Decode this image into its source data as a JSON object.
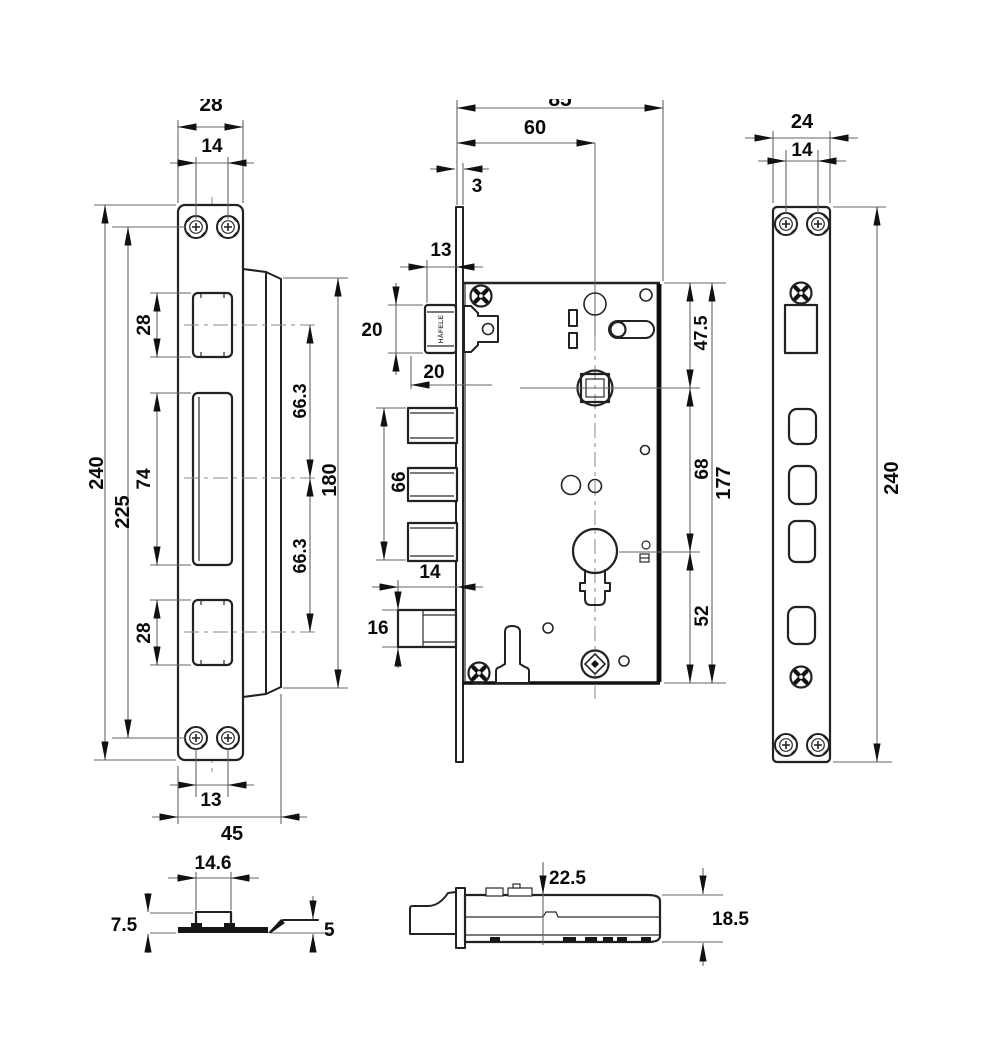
{
  "drawing": {
    "type": "mortise-lock-dimension-drawing",
    "colors": {
      "line": "#222222",
      "dim_line": "#666666",
      "text": "#0a0a0a",
      "background": "#ffffff"
    },
    "strike": {
      "plate_width": "28",
      "screw_pitch_top": "14",
      "height_total": "240",
      "screw_span": "225",
      "cutout_top_h": "28",
      "cutout_mid_h": "74",
      "cutout_bot_h": "28",
      "spacing_upper": "66.3",
      "spacing_lower": "66.3",
      "lip_span": "180",
      "screw_pitch_bottom": "13",
      "depth_with_lip": "45"
    },
    "body": {
      "case_depth": "85",
      "backset": "60",
      "faceplate_thickness": "3",
      "latch_width": "13",
      "latch_height": "20",
      "latch_projection": "20",
      "bolt_group_height": "66",
      "bolt_projection": "14",
      "bolt_height": "16",
      "edge_to_follower": "47.5",
      "follower_to_cylinder": "68",
      "cylinder_to_edge": "52",
      "case_height": "177",
      "latch_brand": "HÄFELE"
    },
    "face": {
      "width": "24",
      "screw_pitch": "14",
      "height": "240"
    },
    "strike_section": {
      "channel_width": "14.6",
      "box_depth": "7.5",
      "lip_height": "5"
    },
    "body_section": {
      "top_offset": "22.5",
      "case_thickness": "18.5"
    }
  }
}
